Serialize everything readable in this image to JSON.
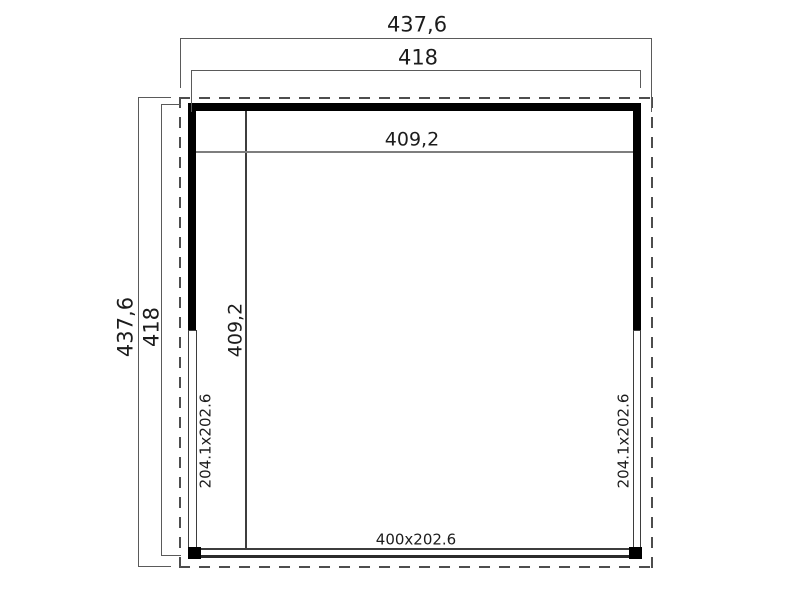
{
  "labels": {
    "outer_width": "437,6",
    "wall_width": "418",
    "inner_width": "409,2",
    "outer_height": "437,6",
    "wall_height": "418",
    "inner_height": "409,2",
    "left_opening": "204.1x202.6",
    "right_opening": "204.1x202.6",
    "front_opening": "400x202.6"
  },
  "colors": {
    "wall": "#000000",
    "structure_line": "#3d3d3d",
    "dimension_line": "#5a5a5a",
    "roof_dash": "#4d4d4d",
    "text": "#1c1c1c",
    "background": "#ffffff"
  }
}
